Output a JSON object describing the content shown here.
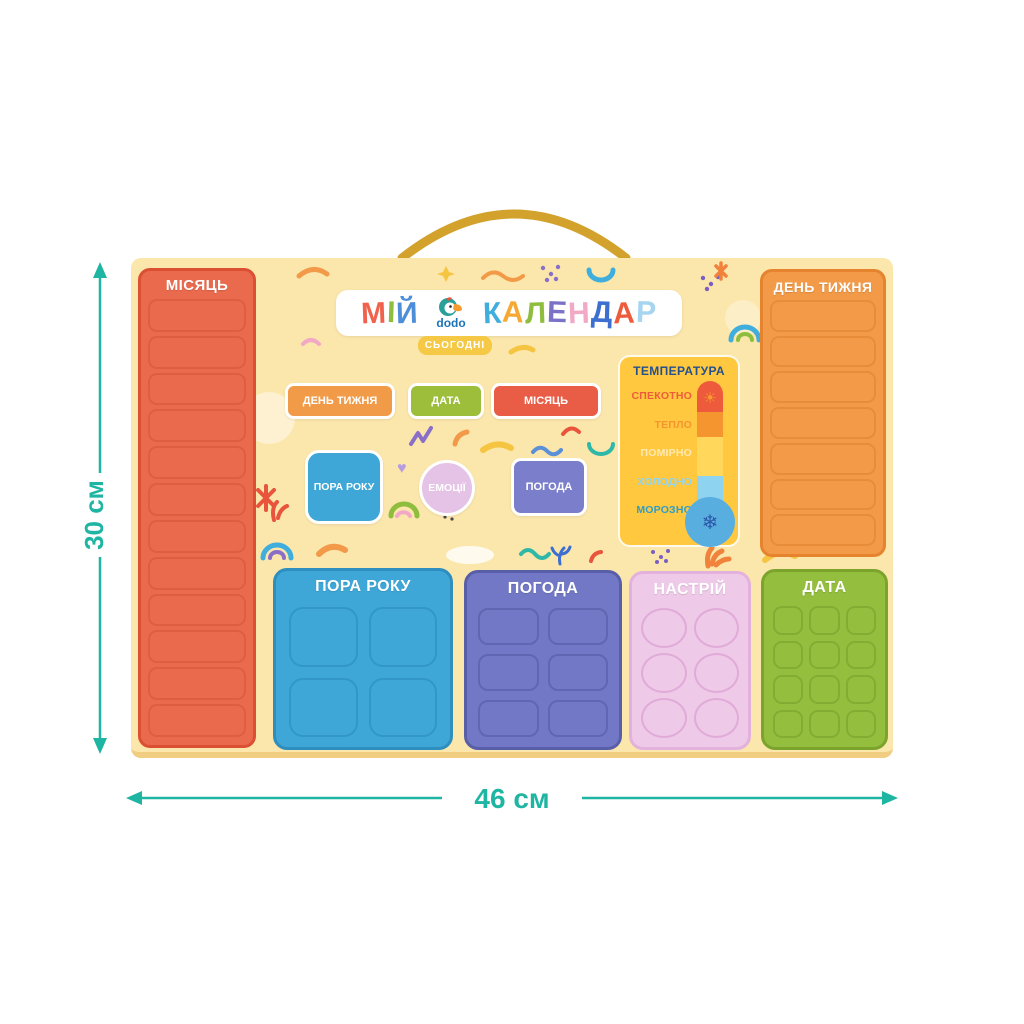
{
  "dimensions": {
    "height_label": "30 см",
    "width_label": "46 см",
    "color": "#1FB5A3"
  },
  "rope": {
    "color": "#D2A22C"
  },
  "board": {
    "bg": "#FBE6AB",
    "edge": "#F0CD80",
    "title_banner": {
      "part1": [
        {
          "ch": "М",
          "color": "#F0624E"
        },
        {
          "ch": "І",
          "color": "#8FBE3F"
        },
        {
          "ch": "Й",
          "color": "#4C8FD8"
        }
      ],
      "part2": [
        {
          "ch": "К",
          "color": "#3FAEDC"
        },
        {
          "ch": "А",
          "color": "#F5A933"
        },
        {
          "ch": "Л",
          "color": "#8FBE3F"
        },
        {
          "ch": "Е",
          "color": "#7B72C8"
        },
        {
          "ch": "Н",
          "color": "#F2A9C6"
        },
        {
          "ch": "Д",
          "color": "#3C6FD0"
        },
        {
          "ch": "А",
          "color": "#EE5B3C"
        },
        {
          "ch": "Р",
          "color": "#A5D5EF"
        }
      ],
      "logo": {
        "text": "dodo",
        "color": "#1C74B6"
      }
    },
    "today": {
      "label": "СЬОГОДНІ",
      "bg": "#F5C945"
    },
    "cards": {
      "weekday": {
        "label": "ДЕНЬ ТИЖНЯ",
        "color": "#F19A47"
      },
      "date": {
        "label": "ДАТА",
        "color": "#9CBE3B"
      },
      "month": {
        "label": "МІСЯЦЬ",
        "color": "#E95C46"
      },
      "season": {
        "label": "ПОРА РОКУ",
        "color": "#3EA7D7"
      },
      "emotions": {
        "label": "ЕМОЦІЇ",
        "color": "#E5C3E6"
      },
      "weather": {
        "label": "ПОГОДА",
        "color": "#7B7FCB"
      }
    },
    "panels": {
      "month": {
        "label": "МІСЯЦЬ",
        "slots": 12,
        "color": "#EA6A4E",
        "border": "#DB4F33",
        "slot_border": "#DE5E42"
      },
      "weekday": {
        "label": "ДЕНЬ ТИЖНЯ",
        "slots": 7,
        "color": "#F29A47",
        "border": "#E5832F",
        "slot_border": "#E78D3A"
      },
      "season": {
        "label": "ПОРА РОКУ",
        "slots": 4,
        "color": "#3EA7D7",
        "border": "#2E8EBD",
        "slot_border": "#3296C8"
      },
      "weather": {
        "label": "ПОГОДА",
        "slots": 6,
        "color": "#7278C5",
        "border": "#585EA8",
        "slot_border": "#6066B1"
      },
      "mood": {
        "label": "НАСТРІЙ",
        "slots": 6,
        "color": "#EFC9E8",
        "border": "#E3B2DC",
        "slot_border": "#E0ABD8"
      },
      "date": {
        "label": "ДАТА",
        "slots": 12,
        "color": "#94BE3E",
        "border": "#7CA42D",
        "slot_border": "#83AC33"
      }
    },
    "temperature": {
      "title": "ТЕМПЕРАТУРА",
      "title_color": "#24508F",
      "bg": "#FFC83E",
      "levels": [
        {
          "label": "СПЕКОТНО",
          "color": "#EE5B3C"
        },
        {
          "label": "ТЕПЛО",
          "color": "#F5952F"
        },
        {
          "label": "ПОМІРНО",
          "color": "#FFE9B3"
        },
        {
          "label": "ХОЛОДНО",
          "color": "#8ED4F0"
        },
        {
          "label": "МОРОЗНО",
          "color": "#2E9EC9"
        }
      ],
      "thermometer": {
        "segments": [
          "#EE5B3C",
          "#F5952F",
          "#FFD75A",
          "#8ED4F0"
        ],
        "bulb": "#59AEE0",
        "sun": "#F59B2F",
        "snowflake": "#2B57A8",
        "sun_icon": "☀",
        "snow_icon": "❄"
      }
    }
  }
}
